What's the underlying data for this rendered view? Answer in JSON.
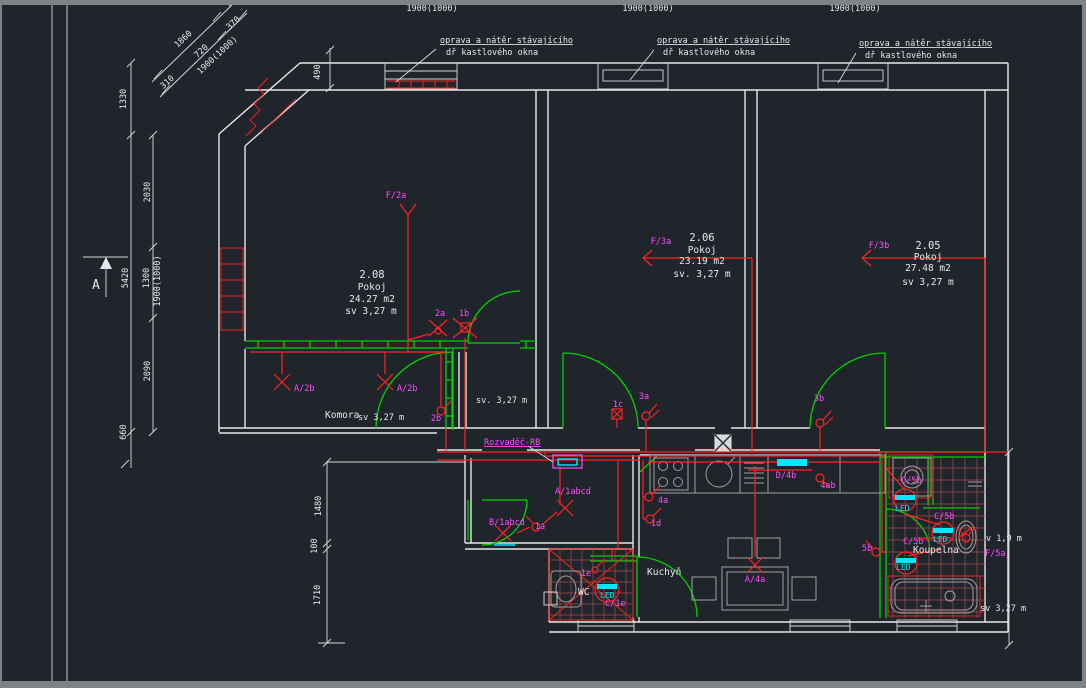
{
  "window_notes": {
    "line1": "oprava a nátěr stávajícího",
    "line2": "dř  kastlového okna"
  },
  "top_dimensions": {
    "d1": "1900(1000)",
    "d2": "1900(1000)",
    "d3": "1900(1000)"
  },
  "diagonal_dimensions": {
    "d1860": "1860",
    "d720": "720",
    "d1900": "1900(1000)",
    "d370": "370",
    "d310": "310"
  },
  "left_dimensions": {
    "outer": {
      "d1330": "1330",
      "d5420": "5420",
      "d660": "660"
    },
    "inner": {
      "d2030": "2030",
      "d1300": "1300",
      "d1900": "1900(1000)",
      "d2090": "2090"
    },
    "d490": "490",
    "section_mark": "A"
  },
  "lowerleft_dimensions": {
    "d1480": "1480",
    "d100": "100",
    "d1710": "1710"
  },
  "rooms": {
    "r208": {
      "number": "2.08",
      "type": "Pokoj",
      "area": "24.27 m2",
      "clear_height": "sv 3,27 m"
    },
    "r206": {
      "number": "2.06",
      "type": "Pokoj",
      "area": "23.19 m2",
      "clear_height": "sv. 3,27 m"
    },
    "r205": {
      "number": "2.05",
      "type": "Pokoj",
      "area": "27.48 m2",
      "clear_height": "sv 3,27 m"
    },
    "komora": {
      "name": "Komora",
      "clear_height": "sv 3,27 m"
    },
    "lobby": {
      "clear_height": "sv. 3,27 m"
    },
    "kitchen": {
      "name": "Kuchyň"
    },
    "bathroom": {
      "name": "Koupelna",
      "clear_height": "sv 3,27 m",
      "basin_height": "v 1,9 m"
    },
    "wc": {
      "name": "WC"
    }
  },
  "electrical": {
    "panel": "Rozvaděč-RB",
    "feeds": {
      "f2a": "F/2a",
      "f3a": "F/3a",
      "f3b": "F/3b",
      "f5a": "F/5a"
    },
    "circuits": {
      "a2b": "A/2b",
      "a1abcd": "A/1abcd",
      "b1abcd": "B/1abcd",
      "a4a": "A/4a",
      "d4b": "D/4b",
      "c5b": "C/5b",
      "c1e": "C/1e"
    },
    "points": {
      "p2a": "2a",
      "p1b": "1b",
      "p2b": "2b",
      "p1c": "1c",
      "p3a": "3a",
      "p3b": "3b",
      "p1a": "1a",
      "p1d": "1d",
      "p4a": "4a",
      "p4ab": "4ab",
      "p5b": "5b",
      "p1e": "1e"
    },
    "led": "LED"
  }
}
